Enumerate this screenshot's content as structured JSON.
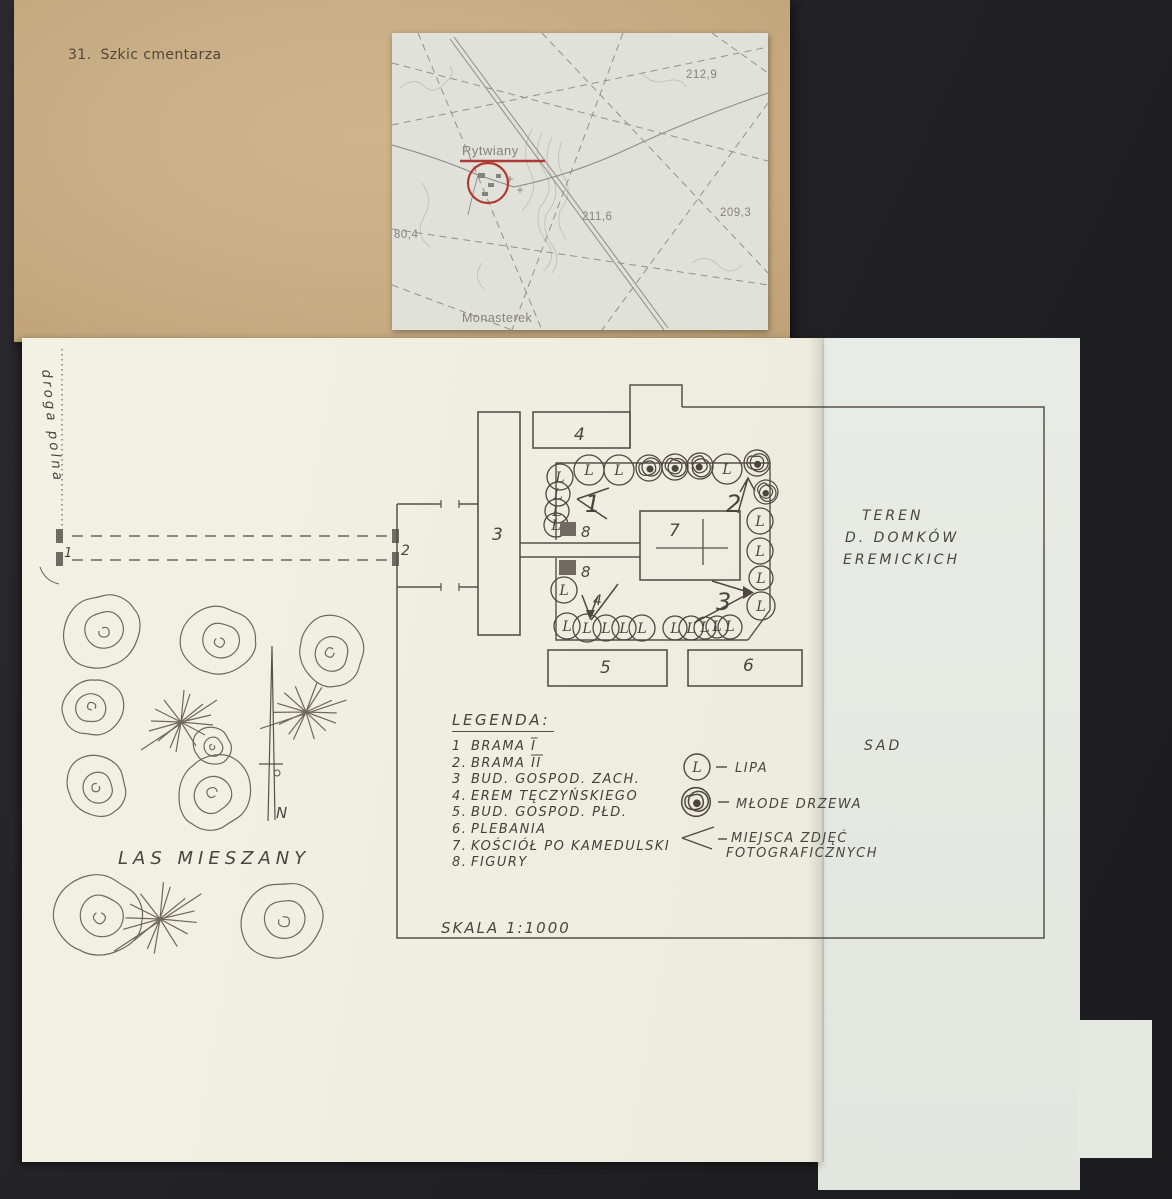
{
  "colors": {
    "background": "#222226",
    "card_tan": "#c8ad84",
    "map_paper": "#e0e1da",
    "map_accent_red": "#ae3a33",
    "sheet_warm": "#f2f0e3",
    "sheet_cool": "#e7eae4",
    "pencil_ink": "#57514a"
  },
  "card": {
    "caption_number": "31.",
    "caption_title": "Szkic cmentarza"
  },
  "map_inset": {
    "town_label": "Rytwiany",
    "hamlet_label": "Monasterek",
    "elevation_ne": "212,9",
    "elevation_e": "209,3",
    "elevation_center": "211,6",
    "elevation_w": "80,4"
  },
  "plan": {
    "road_label": "droga polna",
    "forest_label": "LAS  MIESZANY",
    "north_label": "N",
    "area_label": {
      "line1": "TEREN",
      "line2": "D. DOMKÓW",
      "line3": "EREMICKICH"
    },
    "orchard_label": "SAD",
    "scale_label": "SKALA  1:1000",
    "lipa_letter": "L",
    "building_labels": {
      "b3": "3",
      "b4": "4",
      "b5": "5",
      "b6": "6",
      "b7": "7"
    },
    "gate_labels": {
      "g1": "1",
      "g2": "2"
    },
    "figure_label": "8",
    "photo_labels": {
      "p1": "1",
      "p2": "2",
      "p3": "3",
      "p4": "4"
    }
  },
  "legend": {
    "title": "LEGENDA:",
    "items": [
      {
        "num": "1",
        "label": "BRAMA I̅"
      },
      {
        "num": "2.",
        "label": "BRAMA I̅I̅"
      },
      {
        "num": "3",
        "label": "BUD. GOSPOD. ZACH."
      },
      {
        "num": "4.",
        "label": "EREM TĘCZYŃSKIEGO"
      },
      {
        "num": "5.",
        "label": "BUD. GOSPOD. PŁD."
      },
      {
        "num": "6.",
        "label": "PLEBANIA"
      },
      {
        "num": "7.",
        "label": "KOŚCIÓŁ PO KAMEDULSKI"
      },
      {
        "num": "8.",
        "label": "FIGURY"
      }
    ],
    "symbols": [
      {
        "label": "LIPA"
      },
      {
        "label": "MŁODE DRZEWA"
      },
      {
        "label": "MIEJSCA ZDJĘĆ",
        "label2": "FOTOGRAFICZNYCH"
      }
    ]
  }
}
